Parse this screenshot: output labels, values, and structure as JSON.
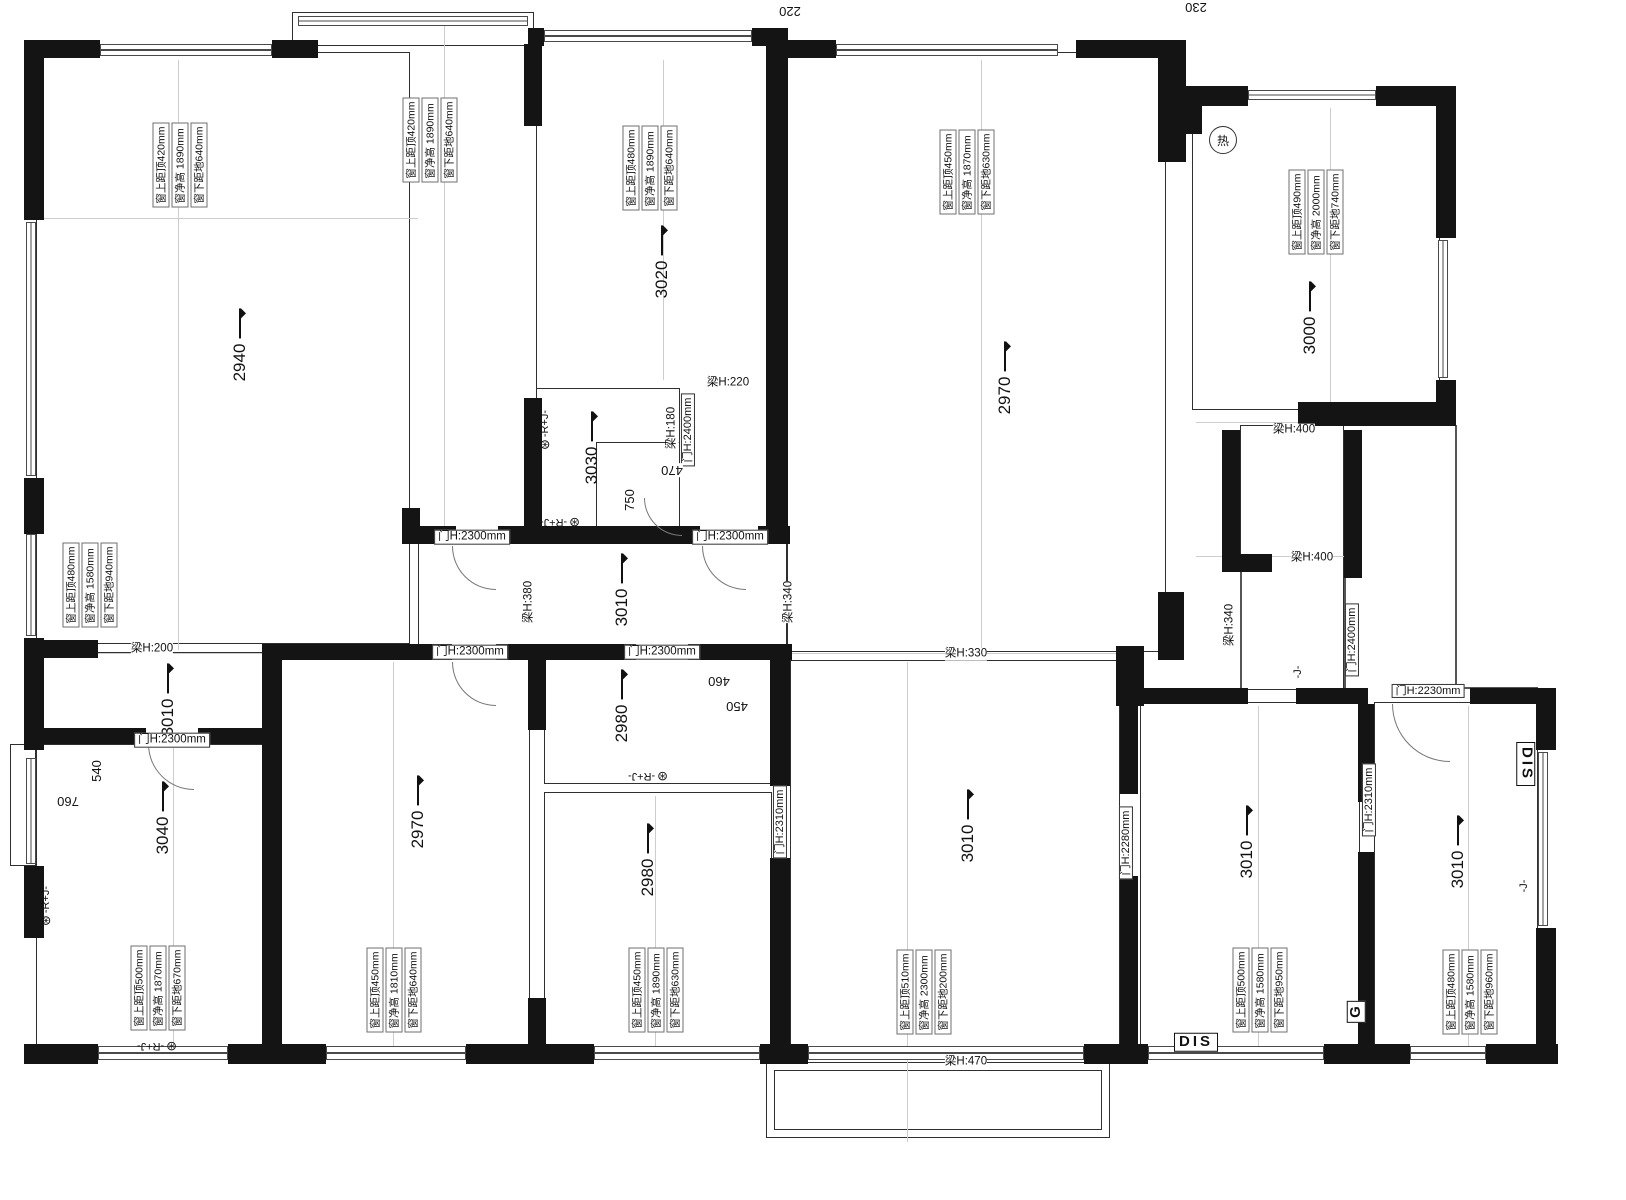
{
  "plan": {
    "colors": {
      "wall": "#141414",
      "outline": "#2f2f2f",
      "line": "#555555",
      "dimline": "#cdcdcd",
      "background": "#ffffff",
      "text": "#111111"
    },
    "top_dims": [
      "220",
      "230"
    ],
    "rooms": [
      {
        "height": "2940"
      },
      {
        "height": "3020"
      },
      {
        "height": "3030"
      },
      {
        "height": "2970"
      },
      {
        "height": "3000"
      },
      {
        "height": "3010"
      },
      {
        "height": "3010"
      },
      {
        "height": "3040"
      },
      {
        "height": "2970"
      },
      {
        "height": "2980"
      },
      {
        "height": "2980"
      },
      {
        "height": "3010"
      },
      {
        "height": "3010"
      },
      {
        "height": "3010"
      }
    ],
    "beams": [
      "梁H:220",
      "梁H:180",
      "梁H:400",
      "梁H:400",
      "梁H:340",
      "梁H:330",
      "梁H:380",
      "梁H:340",
      "梁H:200",
      "梁H:470"
    ],
    "doors": [
      "门H:2300mm",
      "门H:2300mm",
      "门H:2300mm",
      "门H:2300mm",
      "门H:2300mm",
      "门H:2400mm",
      "门H:2400mm",
      "门H:2230mm",
      "门H:2310mm",
      "门H:2280mm",
      "门H:2310mm"
    ],
    "windows": [
      {
        "top": "窗上距顶420mm",
        "clear": "窗净高 1890mm",
        "sill": "窗下距地640mm"
      },
      {
        "top": "窗上距顶420mm",
        "clear": "窗净高 1890mm",
        "sill": "窗下距地640mm"
      },
      {
        "top": "窗上距顶480mm",
        "clear": "窗净高 1890mm",
        "sill": "窗下距地640mm"
      },
      {
        "top": "窗上距顶450mm",
        "clear": "窗净高 1870mm",
        "sill": "窗下距地630mm"
      },
      {
        "top": "窗上距顶490mm",
        "clear": "窗净高 2000mm",
        "sill": "窗下距地740mm"
      },
      {
        "top": "窗上距顶480mm",
        "clear": "窗净高 1580mm",
        "sill": "窗下距地940mm"
      },
      {
        "top": "窗上距顶500mm",
        "clear": "窗净高 1870mm",
        "sill": "窗下距地670mm"
      },
      {
        "top": "窗上距顶450mm",
        "clear": "窗净高 1810mm",
        "sill": "窗下距地640mm"
      },
      {
        "top": "窗上距顶450mm",
        "clear": "窗净高 1890mm",
        "sill": "窗下距地630mm"
      },
      {
        "top": "窗上距顶510mm",
        "clear": "窗净高 2300mm",
        "sill": "窗下距地200mm"
      },
      {
        "top": "窗上距顶500mm",
        "clear": "窗净高 1580mm",
        "sill": "窗下距地950mm"
      },
      {
        "top": "窗上距顶480mm",
        "clear": "窗净高 1580mm",
        "sill": "窗下距地960mm"
      }
    ],
    "dims": [
      "470",
      "750",
      "460",
      "450",
      "540",
      "760"
    ],
    "devices": {
      "heater": "热",
      "dis": "DIS",
      "g": "G",
      "ds": "DIS",
      "sprinkler": "-R+J-",
      "j": "-J-"
    }
  }
}
